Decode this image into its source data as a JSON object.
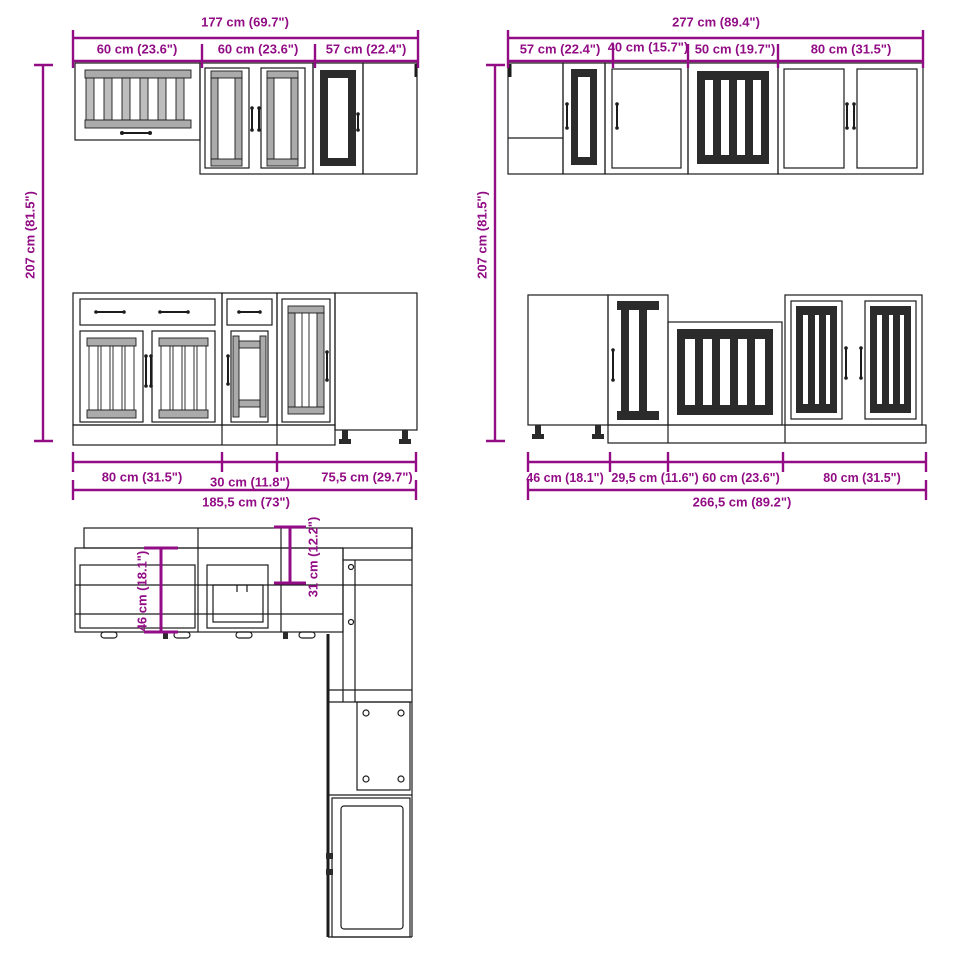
{
  "title": "Kitchen cabinet set dimensional drawing",
  "colors": {
    "dimension_magenta": "#920D85",
    "line_black": "#1C1C1C",
    "slat_gray": "#ABABAB",
    "slat_dark": "#2B2B2B",
    "background": "#FFFFFF"
  },
  "wall_left": {
    "total": "177 cm (69.7\")",
    "seg1": "60 cm (23.6\")",
    "seg2": "60 cm (23.6\")",
    "seg3": "57 cm (22.4\")",
    "height": "207 cm (81.5\")"
  },
  "wall_right": {
    "total": "277 cm (89.4\")",
    "seg1": "57 cm (22.4\")",
    "seg2": "40 cm (15.7\")",
    "seg3": "50 cm (19.7\")",
    "seg4": "80 cm (31.5\")",
    "height": "207 cm (81.5\")"
  },
  "base_left": {
    "seg1": "80 cm (31.5\")",
    "seg2": "30 cm (11.8\")",
    "seg3": "75,5 cm (29.7\")",
    "total": "185,5 cm (73\")"
  },
  "base_right": {
    "seg1": "46 cm (18.1\")",
    "seg2": "29,5 cm (11.6\")",
    "seg3": "60 cm (23.6\")",
    "seg4": "80 cm (31.5\")",
    "total": "266,5 cm (89.2\")"
  },
  "top_view": {
    "base_depth": "46 cm (18.1\")",
    "wall_depth": "31 cm (12.2\")"
  }
}
